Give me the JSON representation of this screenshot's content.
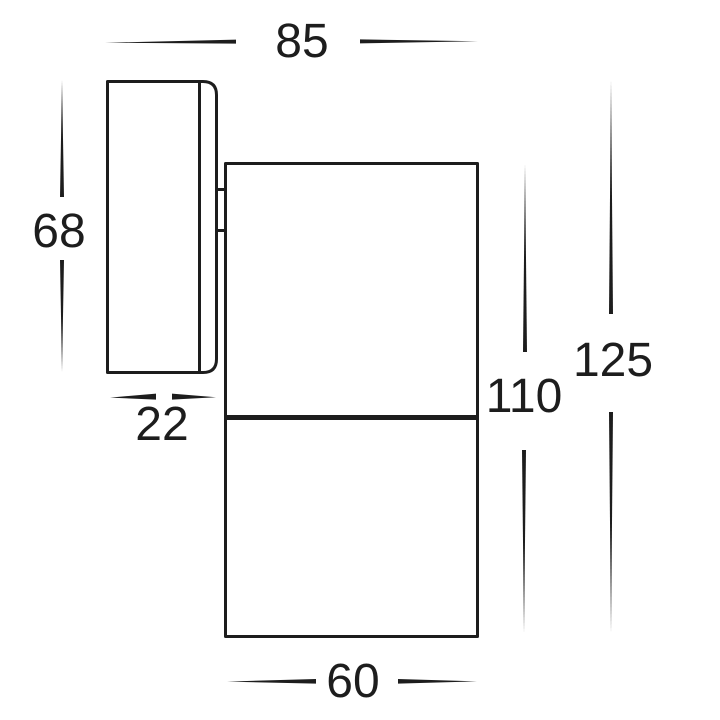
{
  "diagram": {
    "type": "technical-dimension-drawing",
    "subject": "wall-mounted exterior spotlight side profile",
    "background_color": "#ffffff",
    "line_color": "#1d1d1d",
    "dimensions": {
      "overall_depth": "85",
      "backplate_height": "68",
      "backplate_depth": "22",
      "body_height": "110",
      "overall_height": "125",
      "body_width": "60"
    }
  }
}
